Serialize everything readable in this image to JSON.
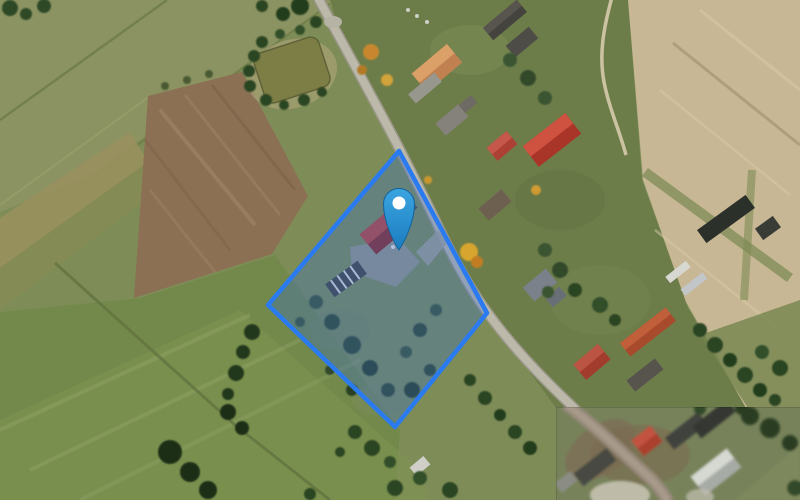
{
  "app": {
    "view": "satellite-map-viewport",
    "width_px": 800,
    "height_px": 500
  },
  "map": {
    "imagery_type": "aerial-photo",
    "scene": "rural village: green fields, plowed brown field, pond, country road, farm houses with red roofs",
    "tile_patch": {
      "visible": true,
      "x": 556,
      "y": 407,
      "width": 244,
      "height": 93,
      "description": "lower-resolution imagery patch in bottom-right corner"
    }
  },
  "overlays": {
    "parcel_polygon": {
      "points": [
        [
          399,
          151
        ],
        [
          487,
          313
        ],
        [
          395,
          427
        ],
        [
          268,
          305
        ]
      ],
      "stroke_color": "#2b7bf0",
      "fill_color": "rgba(45,105,215,0.30)",
      "stroke_width": 4.5
    },
    "marker": {
      "x": 399,
      "y": 204,
      "head_radius": 15.5,
      "tip_y": 250,
      "fill_top": "#3ba5e0",
      "fill_bottom": "#1b7cc0",
      "outline_color": "#13639c",
      "dot_color": "#ffffff",
      "dot_radius": 6.5
    }
  },
  "palette": {
    "field_green": "#7e8d57",
    "meadow_green": "#73894b",
    "plowed_brown": "#8b7054",
    "harvest_tan": "#c8b794",
    "road_gray": "#bcb9aa",
    "pond_olive": "#7d7e45",
    "roof_red": "#bf4034",
    "tree_dark_green": "#2c4522"
  }
}
